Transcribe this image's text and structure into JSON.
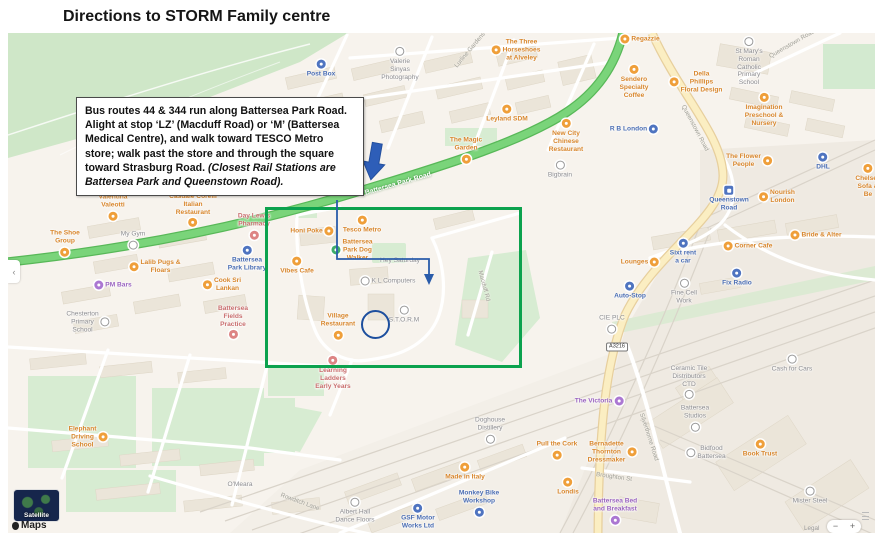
{
  "title": "Directions to STORM Family centre",
  "callout": {
    "main": "Bus routes 44 & 344 run along Battersea Park Road. Alight at stop ‘LZ’ (Macduff Road) or ‘M’ (Battersea Medical Centre), and walk toward TESCO Metro store; walk past the store and through the square toward Strasburg Road. ",
    "italic": "(Closest Rail Stations are Battersea Park and Queenstown Road)."
  },
  "colors": {
    "highlight_green": "#0ca24e",
    "route_blue": "#2a5caa",
    "circle_blue": "#1d4f9e",
    "poi_orange": "#d8862c",
    "poi_blue": "#4a6db3",
    "poi_gray": "#8d8d91",
    "poi_red": "#c96e6e",
    "poi_purple": "#9a63c0"
  },
  "controls": {
    "satellite": "Satellite",
    "maps_attribution": "Maps",
    "legal": "Legal",
    "zoom_out": "−",
    "zoom_in": "+",
    "pan_left": "‹"
  },
  "map": {
    "road_badge": "A3216",
    "road_labels": [
      {
        "text": "Battersea Park Road",
        "x": 398,
        "y": 184,
        "rot": -16,
        "color": "white"
      },
      {
        "text": "Lurline Gardens",
        "x": 470,
        "y": 50,
        "rot": -50,
        "color": "gray"
      },
      {
        "text": "Queenstown Road",
        "x": 695,
        "y": 128,
        "rot": 62,
        "color": "gray"
      },
      {
        "text": "Queenstown Road",
        "x": 792,
        "y": 44,
        "rot": -30,
        "color": "gray"
      },
      {
        "text": "Silverthorne Road",
        "x": 649,
        "y": 437,
        "rot": 72,
        "color": "gray"
      },
      {
        "text": "Broughton St",
        "x": 614,
        "y": 477,
        "rot": 8,
        "color": "gray"
      },
      {
        "text": "Macduff Rd",
        "x": 484,
        "y": 286,
        "rot": 75,
        "color": "gray"
      },
      {
        "text": "Rowditch Lane",
        "x": 300,
        "y": 502,
        "rot": 20,
        "color": "gray"
      }
    ],
    "pois": [
      {
        "text": "The Three\nHorseshoes\nat Alveley",
        "x": 516,
        "y": 50,
        "color": "orange",
        "icon": "left"
      },
      {
        "text": "Leyland SDM",
        "x": 507,
        "y": 114,
        "color": "orange",
        "icon": "above"
      },
      {
        "text": "Regazzie",
        "x": 640,
        "y": 39,
        "color": "orange",
        "icon": "left"
      },
      {
        "text": "Sendero\nSpecialty\nCoffee",
        "x": 634,
        "y": 82,
        "color": "orange",
        "icon": "above"
      },
      {
        "text": "Della\nPhillips\nFloral Design",
        "x": 696,
        "y": 82,
        "color": "orange",
        "icon": "left"
      },
      {
        "text": "Imagination\nPreschool &\nNursery",
        "x": 764,
        "y": 110,
        "color": "orange",
        "icon": "above"
      },
      {
        "text": "New City\nChinese\nRestaurant",
        "x": 566,
        "y": 136,
        "color": "orange",
        "icon": "above"
      },
      {
        "text": "The Magic\nGarden",
        "x": 466,
        "y": 150,
        "color": "orange",
        "icon": "below"
      },
      {
        "text": "The Flower\nPeople",
        "x": 749,
        "y": 161,
        "color": "orange",
        "icon": "right"
      },
      {
        "text": "Chelsea\nSofa & Be",
        "x": 868,
        "y": 181,
        "color": "orange",
        "icon": "above"
      },
      {
        "text": "Nourish\nLondon",
        "x": 777,
        "y": 197,
        "color": "orange",
        "icon": "left"
      },
      {
        "text": "Bride & Alter",
        "x": 816,
        "y": 235,
        "color": "orange",
        "icon": "left"
      },
      {
        "text": "Corner Cafe",
        "x": 748,
        "y": 246,
        "color": "orange",
        "icon": "left"
      },
      {
        "text": "Lounges",
        "x": 640,
        "y": 262,
        "color": "orange",
        "icon": "right"
      },
      {
        "text": "Valentina\nValeotti",
        "x": 113,
        "y": 207,
        "color": "orange",
        "icon": "below"
      },
      {
        "text": "Casuale Corelli\nItalian\nRestaurant",
        "x": 193,
        "y": 210,
        "color": "orange",
        "icon": "below"
      },
      {
        "text": "The Shoe\nGroup",
        "x": 65,
        "y": 243,
        "color": "orange",
        "icon": "below"
      },
      {
        "text": "Lalib Pugs &\nFloars",
        "x": 155,
        "y": 267,
        "color": "orange",
        "icon": "left"
      },
      {
        "text": "Cook Sri\nLankan",
        "x": 222,
        "y": 285,
        "color": "orange",
        "icon": "left"
      },
      {
        "text": "Tesco Metro",
        "x": 362,
        "y": 225,
        "color": "orange",
        "icon": "above"
      },
      {
        "text": "Honi Poke",
        "x": 312,
        "y": 231,
        "color": "orange",
        "icon": "right"
      },
      {
        "text": "Battersea\nPark Dog\nWalker",
        "x": 352,
        "y": 250,
        "color": "orange",
        "icon": "left",
        "iconColor": "green"
      },
      {
        "text": "Vibes Cafe",
        "x": 297,
        "y": 266,
        "color": "orange",
        "icon": "above"
      },
      {
        "text": "Village\nRestaurant",
        "x": 338,
        "y": 326,
        "color": "orange",
        "icon": "below"
      },
      {
        "text": "Elephant\nDriving\nSchool",
        "x": 88,
        "y": 437,
        "color": "orange",
        "icon": "right"
      },
      {
        "text": "Made in Italy",
        "x": 465,
        "y": 472,
        "color": "orange",
        "icon": "above"
      },
      {
        "text": "Pull the Cork",
        "x": 557,
        "y": 450,
        "color": "orange",
        "icon": "below"
      },
      {
        "text": "Londis",
        "x": 568,
        "y": 487,
        "color": "orange",
        "icon": "above"
      },
      {
        "text": "Bernadette\nThornton\nDressmaker",
        "x": 612,
        "y": 452,
        "color": "orange",
        "icon": "right"
      },
      {
        "text": "Book Trust",
        "x": 760,
        "y": 449,
        "color": "orange",
        "icon": "above"
      },
      {
        "text": "Post Box",
        "x": 321,
        "y": 69,
        "color": "blue",
        "icon": "above"
      },
      {
        "text": "R B London",
        "x": 634,
        "y": 129,
        "color": "blue",
        "icon": "right"
      },
      {
        "text": "DHL",
        "x": 823,
        "y": 162,
        "color": "blue",
        "icon": "above"
      },
      {
        "text": "Queenstown\nRoad",
        "x": 729,
        "y": 199,
        "color": "blue",
        "icon": "above",
        "type": "station"
      },
      {
        "text": "Battersea\nPark Library",
        "x": 247,
        "y": 259,
        "color": "blue",
        "icon": "above"
      },
      {
        "text": "Sixt rent\na car",
        "x": 683,
        "y": 252,
        "color": "blue",
        "icon": "above"
      },
      {
        "text": "Fix Radio",
        "x": 737,
        "y": 278,
        "color": "blue",
        "icon": "above"
      },
      {
        "text": "Auto-Stop",
        "x": 630,
        "y": 291,
        "color": "blue",
        "icon": "above"
      },
      {
        "text": "GSF Motor\nWorks Ltd",
        "x": 418,
        "y": 517,
        "color": "blue",
        "icon": "above"
      },
      {
        "text": "Monkey Bike\nWorkshop",
        "x": 479,
        "y": 503,
        "color": "blue",
        "icon": "below"
      },
      {
        "text": "Valerie\nSinyas\nPhotography",
        "x": 400,
        "y": 64,
        "color": "gray",
        "icon": "above"
      },
      {
        "text": "St Mary's\nRoman\nCatholic\nPrimary\nSchool",
        "x": 749,
        "y": 62,
        "color": "gray",
        "icon": "above"
      },
      {
        "text": "My Gym",
        "x": 133,
        "y": 240,
        "color": "gray",
        "icon": "below"
      },
      {
        "text": "Bigbrain",
        "x": 560,
        "y": 170,
        "color": "gray",
        "icon": "above"
      },
      {
        "text": "K L Computers",
        "x": 388,
        "y": 281,
        "color": "gray",
        "icon": "left"
      },
      {
        "text": "Hey Saturday",
        "x": 400,
        "y": 261,
        "color": "gray",
        "icon": "none"
      },
      {
        "text": "S.T.O.R.M",
        "x": 404,
        "y": 315,
        "color": "gray",
        "icon": "above"
      },
      {
        "text": "Chesterton\nPrimary\nSchool",
        "x": 88,
        "y": 322,
        "color": "gray",
        "icon": "right"
      },
      {
        "text": "Fine Cell\nWork",
        "x": 684,
        "y": 292,
        "color": "gray",
        "icon": "above"
      },
      {
        "text": "CIE PLC",
        "x": 612,
        "y": 324,
        "color": "gray",
        "icon": "below"
      },
      {
        "text": "Cash for Cars",
        "x": 792,
        "y": 364,
        "color": "gray",
        "icon": "above"
      },
      {
        "text": "Doghouse\nDistillery",
        "x": 490,
        "y": 430,
        "color": "gray",
        "icon": "below"
      },
      {
        "text": "Ceramic Tile\nDistributors\nCTD",
        "x": 689,
        "y": 382,
        "color": "gray",
        "icon": "below"
      },
      {
        "text": "Battersea\nStudios",
        "x": 695,
        "y": 418,
        "color": "gray",
        "icon": "below"
      },
      {
        "text": "Bidfood\nBattersea",
        "x": 706,
        "y": 453,
        "color": "gray",
        "icon": "left"
      },
      {
        "text": "Mister Steel",
        "x": 810,
        "y": 496,
        "color": "gray",
        "icon": "above"
      },
      {
        "text": "Albert Hall\nDance Floors",
        "x": 355,
        "y": 511,
        "color": "gray",
        "icon": "above"
      },
      {
        "text": "O'Meara",
        "x": 240,
        "y": 485,
        "color": "gray",
        "icon": "none"
      },
      {
        "text": "Day Lewis\nPharmacy",
        "x": 254,
        "y": 226,
        "color": "red",
        "icon": "below"
      },
      {
        "text": "Battersea\nFields\nPractice",
        "x": 233,
        "y": 322,
        "color": "red",
        "icon": "below"
      },
      {
        "text": "Learning\nLadders\nEarly Years",
        "x": 333,
        "y": 373,
        "color": "red",
        "icon": "above"
      },
      {
        "text": "PM Bars",
        "x": 113,
        "y": 285,
        "color": "purple",
        "icon": "left"
      },
      {
        "text": "The Victoria",
        "x": 599,
        "y": 401,
        "color": "purple",
        "icon": "right"
      },
      {
        "text": "Battersea Bed\nand Breakfast",
        "x": 615,
        "y": 511,
        "color": "purple",
        "icon": "below"
      }
    ]
  }
}
